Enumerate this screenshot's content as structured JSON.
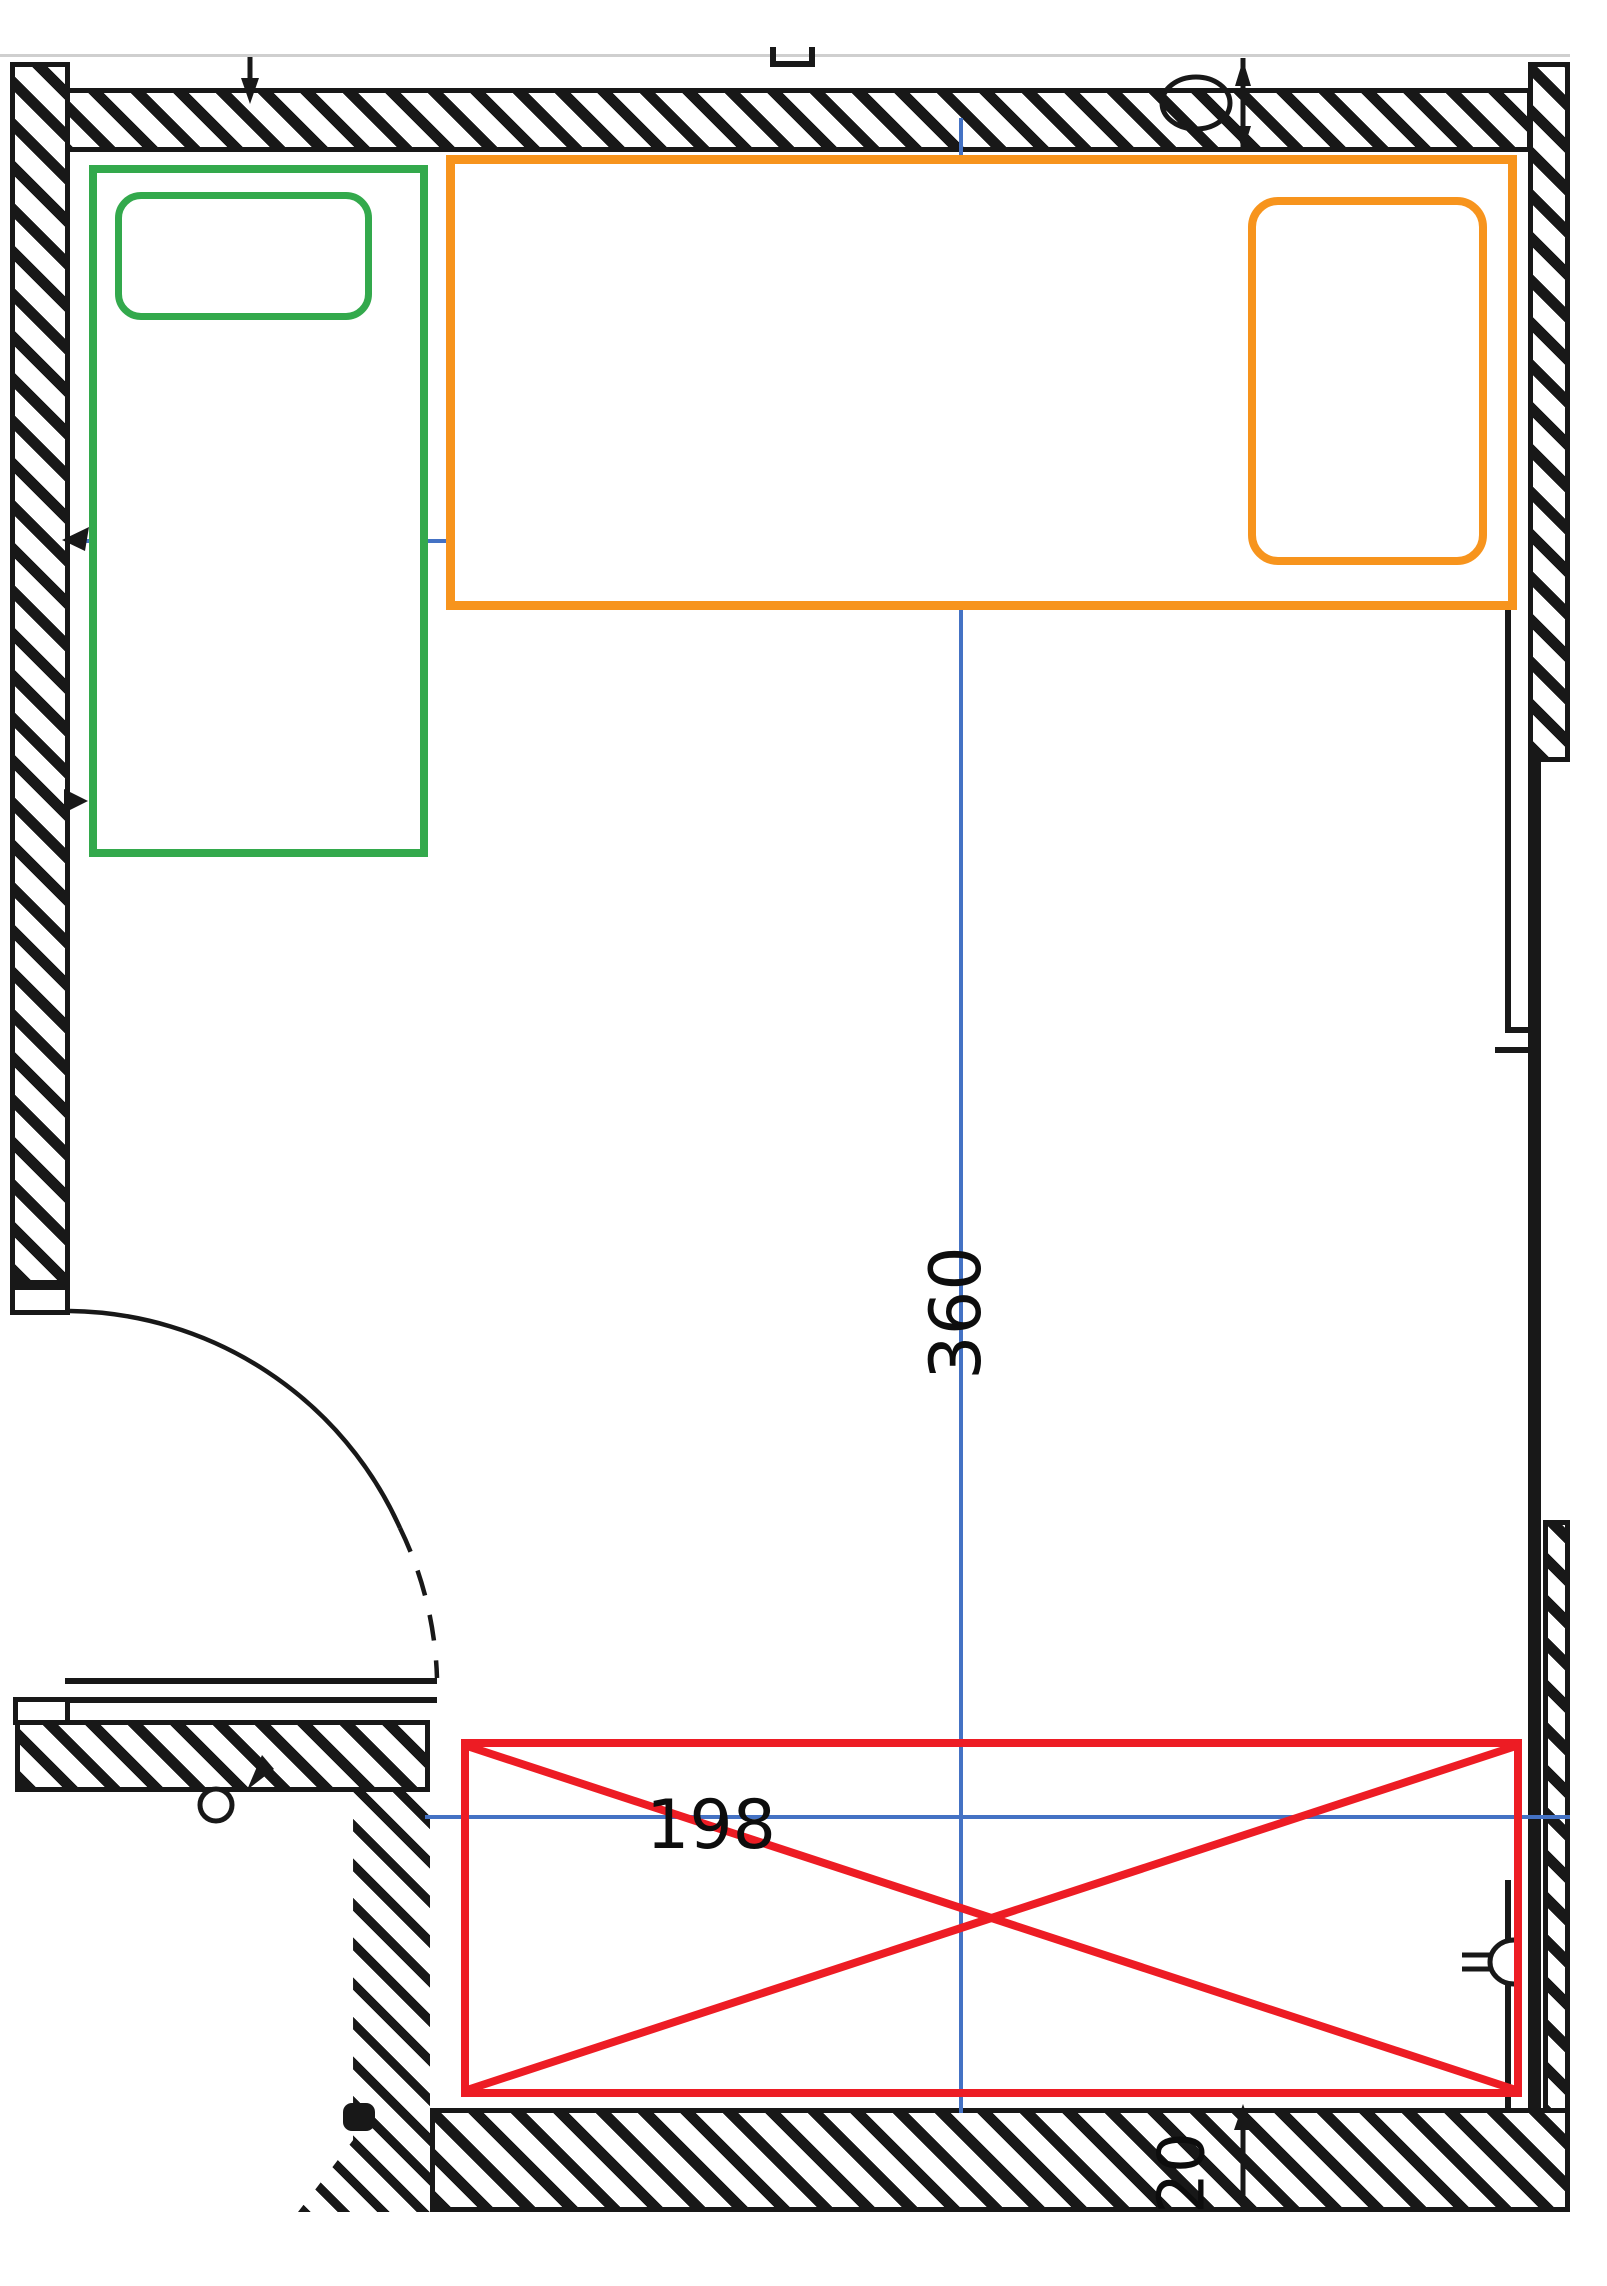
{
  "drawing": {
    "type": "floor-plan",
    "dimensions": {
      "room_length": "360",
      "niche_width": "198",
      "wall_thickness": "20"
    },
    "colors": {
      "line_black": "#181818",
      "dimension_blue": "#4472c4",
      "bed_green": "#33a94c",
      "bed_orange": "#f7941d",
      "blocked_red": "#ed1c24",
      "page_edge_gray": "#cfcfcf"
    }
  }
}
